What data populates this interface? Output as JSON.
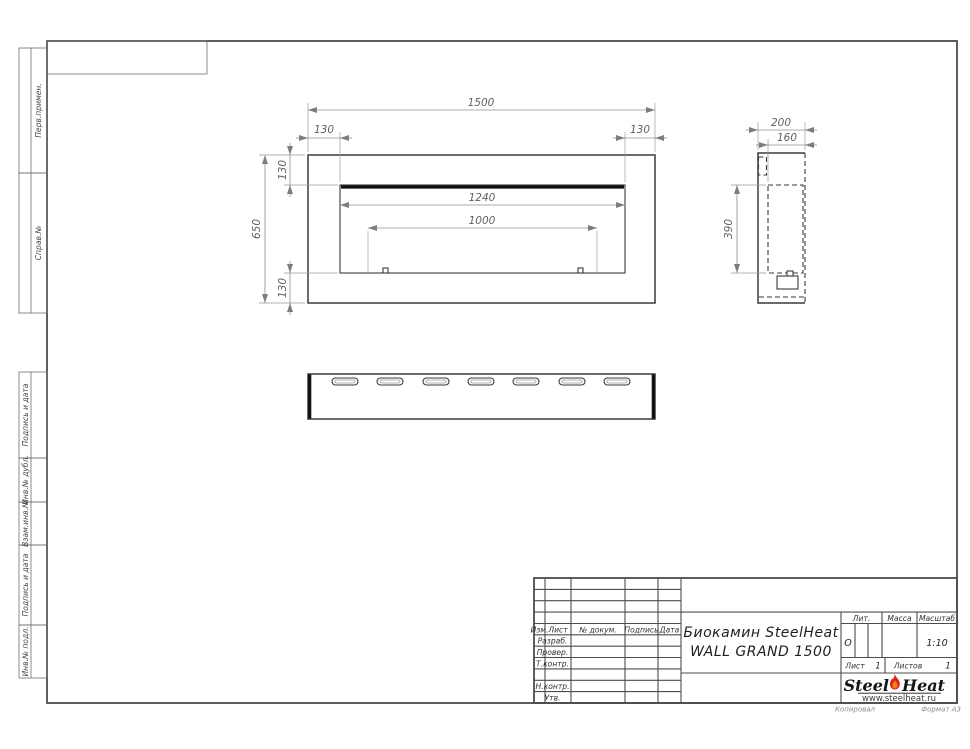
{
  "sheet": {
    "margin_labels": [
      "Перв.примен.",
      "Справ.№",
      "Подпись и дата",
      "Инв.№ дубл.",
      "Взам.инв.№",
      "Подпись и дата",
      "Инв.№ подл."
    ]
  },
  "title_block": {
    "header_cols": [
      "Изм.",
      "Лист",
      "№ докум.",
      "Подпись",
      "Дата"
    ],
    "row_labels": [
      "Разраб.",
      "Провер.",
      "Т.контр.",
      "",
      "Н.контр.",
      "Утв."
    ],
    "doc_title_line1": "Биокамин SteelHeat",
    "doc_title_line2": "WALL GRAND 1500",
    "lit_label": "Лит.",
    "lit_value": "О",
    "mass_label": "Масса",
    "scale_label": "Масштаб",
    "scale_value": "1:10",
    "sheet_label": "Лист",
    "sheet_value": "1",
    "sheets_label": "Листов",
    "sheets_value": "1"
  },
  "logo": {
    "brand_steel": "Steel",
    "brand_heat": "Heat",
    "website": "www.steelheat.ru"
  },
  "footer": {
    "copied_label": "Копировал",
    "format_label": "Формат А3"
  },
  "views": {
    "front": {
      "overall_width": "1500",
      "overall_height": "650",
      "offset_left": "130",
      "offset_right": "130",
      "offset_top": "130",
      "offset_bottom": "130",
      "opening_width": "1240",
      "burner_length": "1000"
    },
    "side": {
      "depth": "200",
      "inner_depth": "160",
      "opening_height": "390"
    }
  }
}
